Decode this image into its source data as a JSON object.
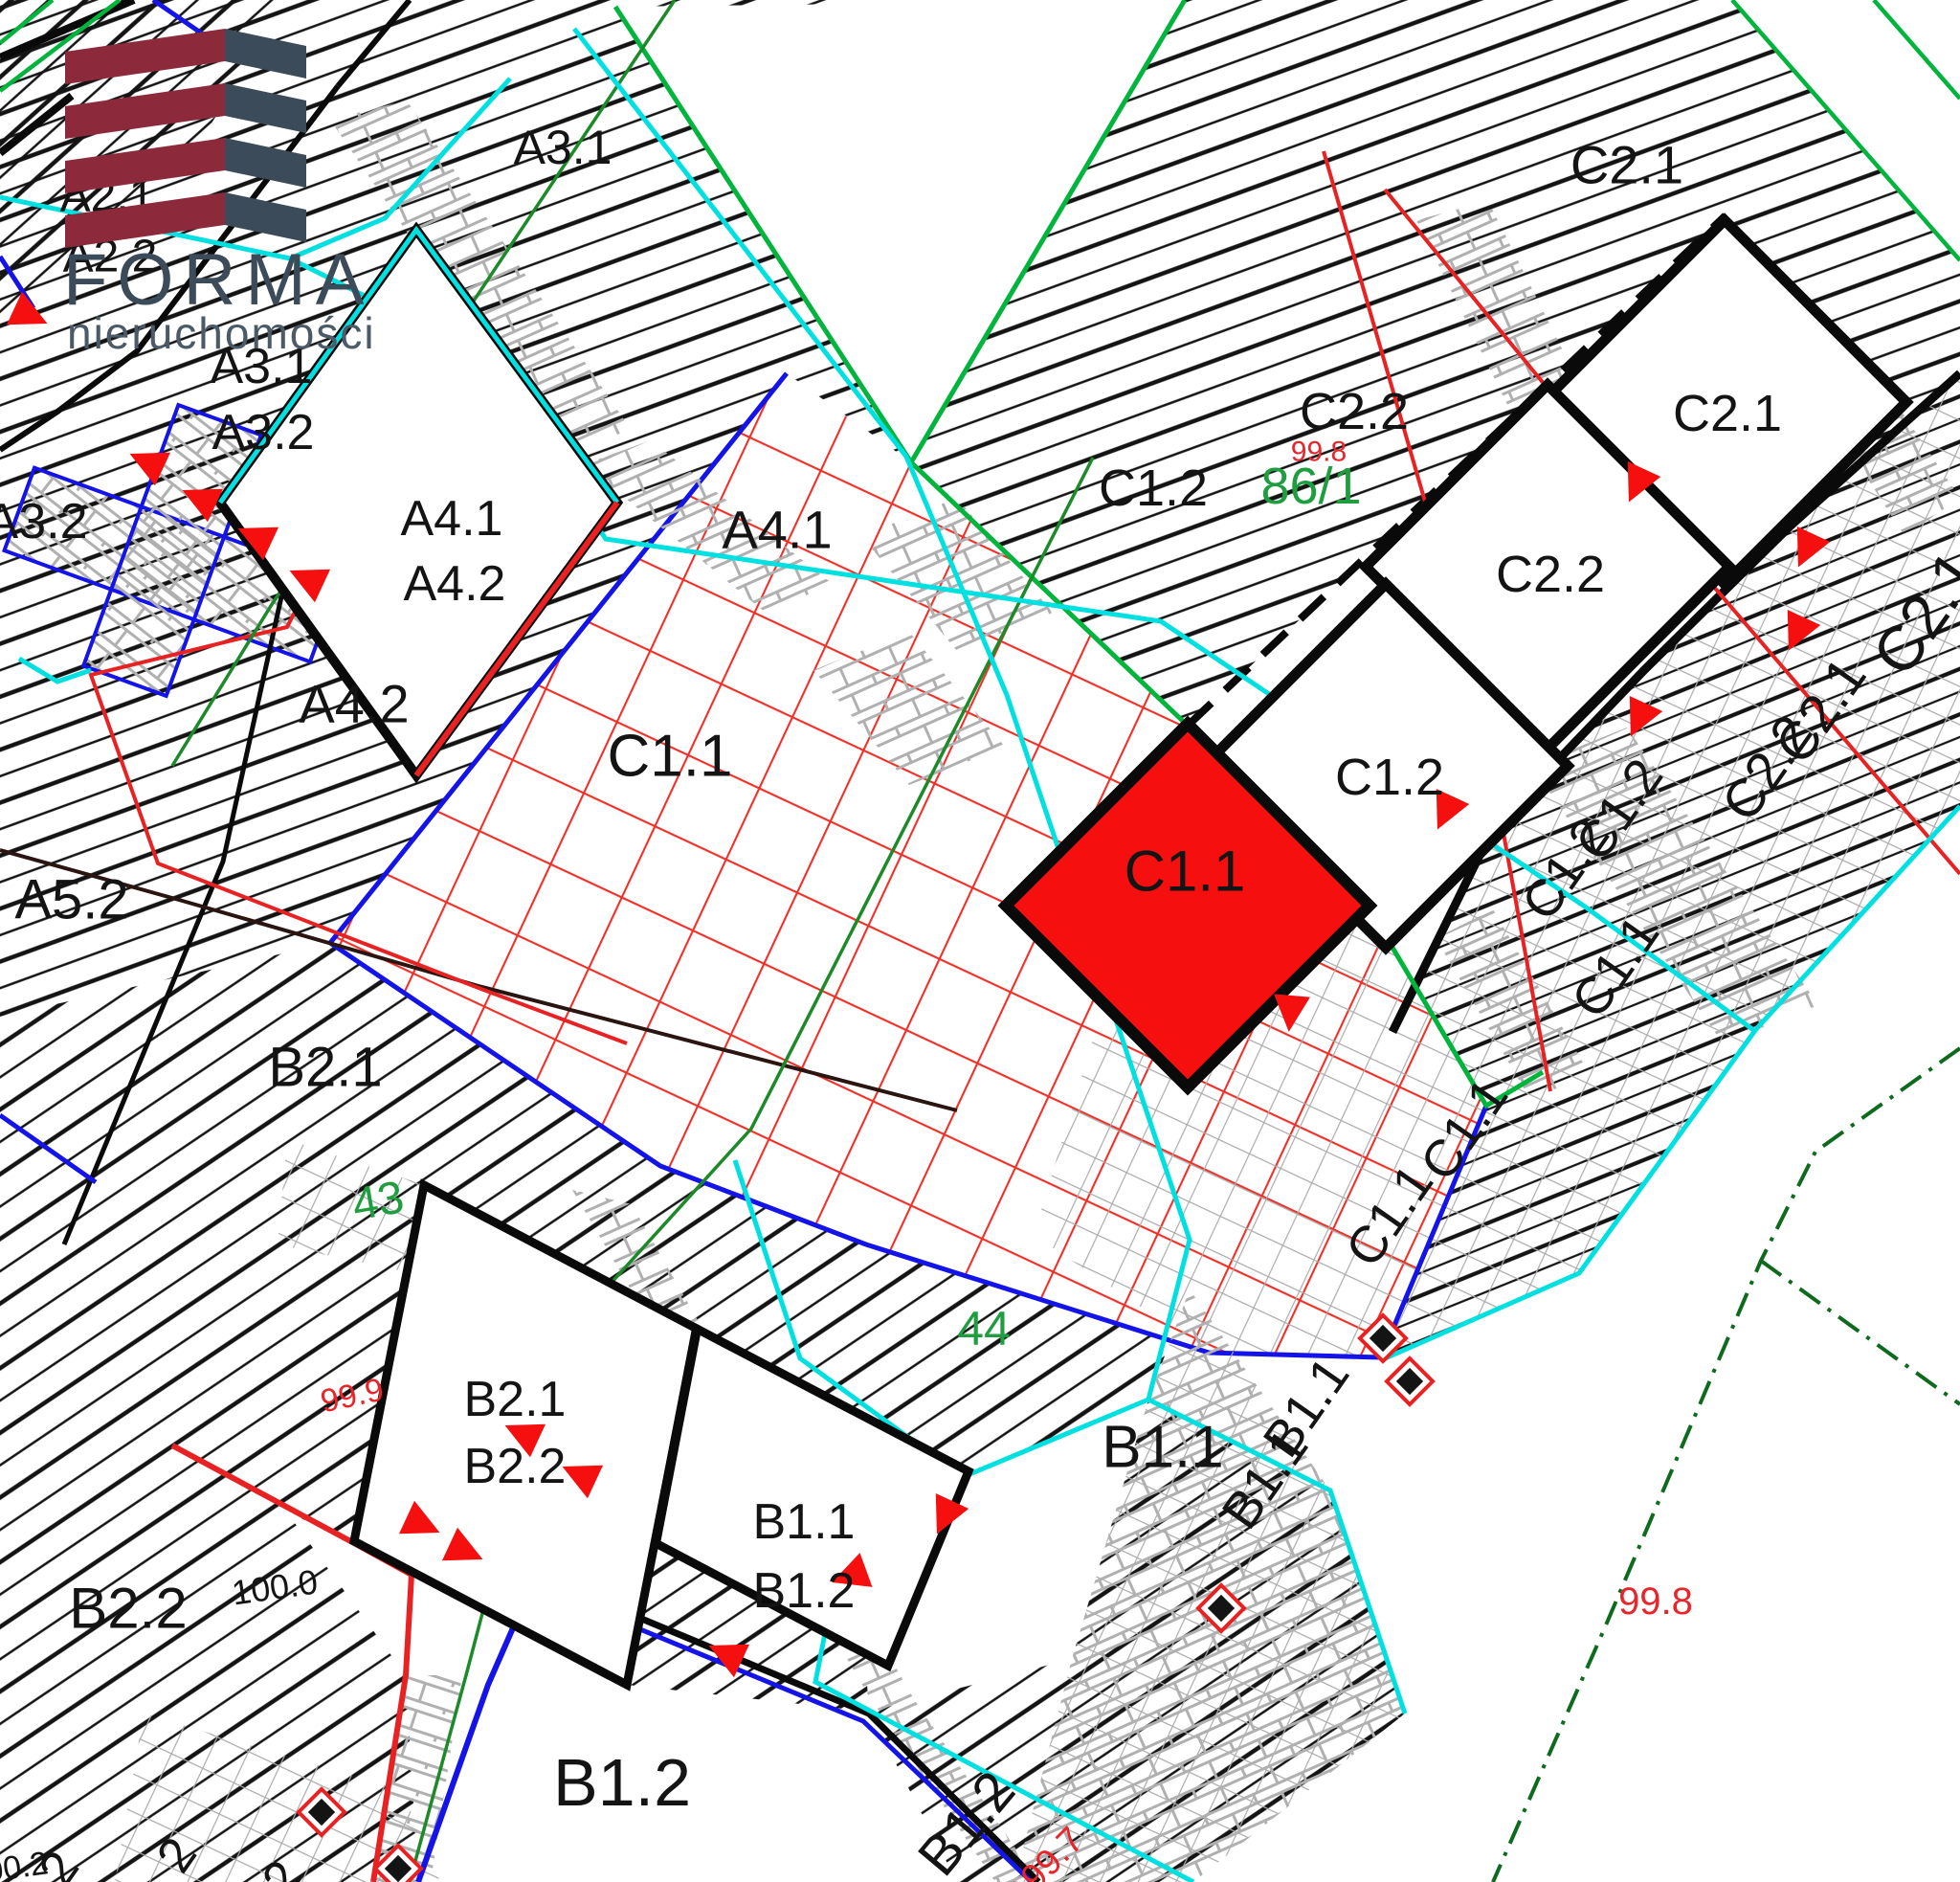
{
  "logo": {
    "title": "FORMA",
    "subtitle": "nieruchomości"
  },
  "areas": {
    "a21": "A2.1",
    "a22": "A2.2",
    "a31_top": "A3.1",
    "a31_mid": "A3.1",
    "a32_mid": "A3.2",
    "a32_left": "A3.2",
    "a41_area": "A4.1",
    "a42_area": "A4.2",
    "a52": "A5.2",
    "b21_area": "B2.1",
    "b22_area": "B2.2",
    "b11_area": "B1.1",
    "b12_area": "B1.2",
    "c11_area": "C1.1",
    "c12_area": "C1.2",
    "c21_area": "C2.1",
    "c22_area": "C2.2"
  },
  "buildings": {
    "a41": "A4.1",
    "a42": "A4.2",
    "b21": "B2.1",
    "b22": "B2.2",
    "b11": "B1.1",
    "b12": "B1.2",
    "c11": "C1.1",
    "c12": "C1.2",
    "c21": "C2.1",
    "c22": "C2.2"
  },
  "parcels": {
    "p86": "86/1",
    "p44": "44",
    "p43": "43"
  },
  "elevations": {
    "e998_top": "99.8",
    "e998_br": "99.8",
    "e999": "99.9",
    "e997": "99.7",
    "d1000": "100.0",
    "d1002": "100.2"
  },
  "rotated": {
    "rca": "C2.1",
    "rcb": "C2.1",
    "rcc": "C2.2",
    "rcd": "C1.2",
    "rce": "C1.2",
    "rcf": "C1.1",
    "rcg": "C1.1",
    "rch": "C1.1",
    "rba": "B1.1",
    "rbb": "B1.1",
    "rbc": "B1.2"
  },
  "partials": {
    "p2a": "2",
    "p2b": "2",
    "p2c": "2"
  },
  "colors": {
    "highlight_building": "#F50F0F",
    "boundary_green": "#00B43C",
    "property_green": "#1C8A28",
    "dashed_green": "#0E6B1E",
    "cyan": "#00E0E0",
    "blue": "#1414E8",
    "red": "#E82222",
    "hatch_black": "#141414",
    "gray_mesh": "#ABABAB",
    "logo_maroon": "#8C2A3C",
    "logo_slate": "#3C4B59"
  }
}
